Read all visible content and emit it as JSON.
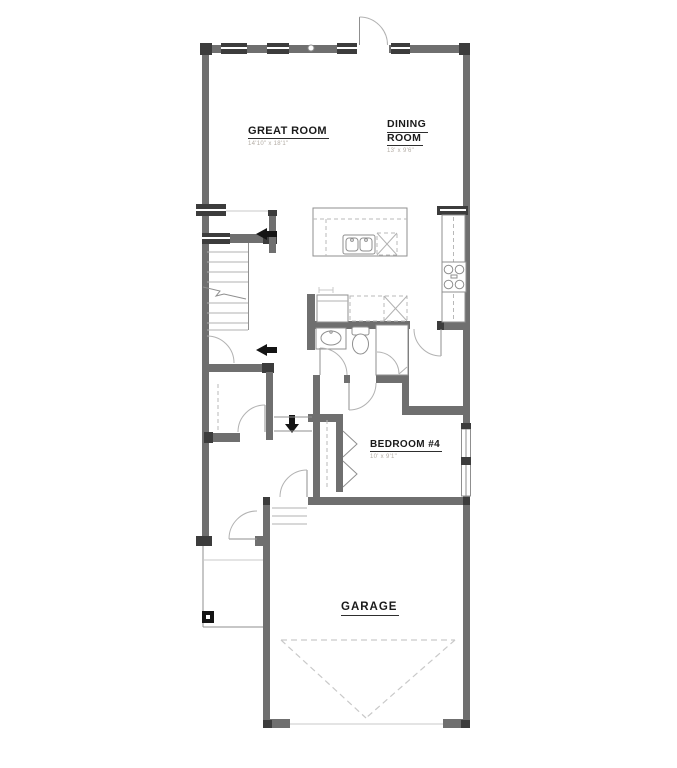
{
  "rooms": {
    "great_room": {
      "name": "GREAT ROOM",
      "dims": "14'10\" x 18'1\""
    },
    "dining_room": {
      "name_line1": "DINING",
      "name_line2": "ROOM",
      "dims": "13' x 9'6\""
    },
    "bedroom_4": {
      "name": "BEDROOM #4",
      "dims": "10' x 9'1\""
    },
    "garage": {
      "name": "GARAGE"
    }
  },
  "symbols": {
    "front_door": "exterior swing door with quarter-circle arc",
    "interior_doors": "quarter-circle swing arcs",
    "windows": "striped wall blocks",
    "staircase": "treads with break line and direction arrows",
    "down_arrow": "black arrow at hall steps",
    "kitchen_island_sink": "double basin sink",
    "dishwasher": "dashed box with X",
    "range_cooktop": "four burner circles",
    "toilet": "tank and oval bowl",
    "vanity_sink": "oval basin in counter",
    "shower": "stall with glass swing arc",
    "closet_rod": "dashed line",
    "bifold_doors": "chevron pair",
    "garage_door_swing": "dashed triangle",
    "porch_post": "black square"
  },
  "colors": {
    "background": "#ffffff",
    "wall": "#6f6f6f",
    "wall_dark": "#3c3c3c",
    "line": "#8f8f8f",
    "line_light": "#c9c9c9",
    "dashed": "#b8b8b8",
    "arc": "#b2b2b2",
    "text": "#1a1a1a",
    "dim_text": "#b3aca4",
    "symbol_black": "#141414"
  }
}
